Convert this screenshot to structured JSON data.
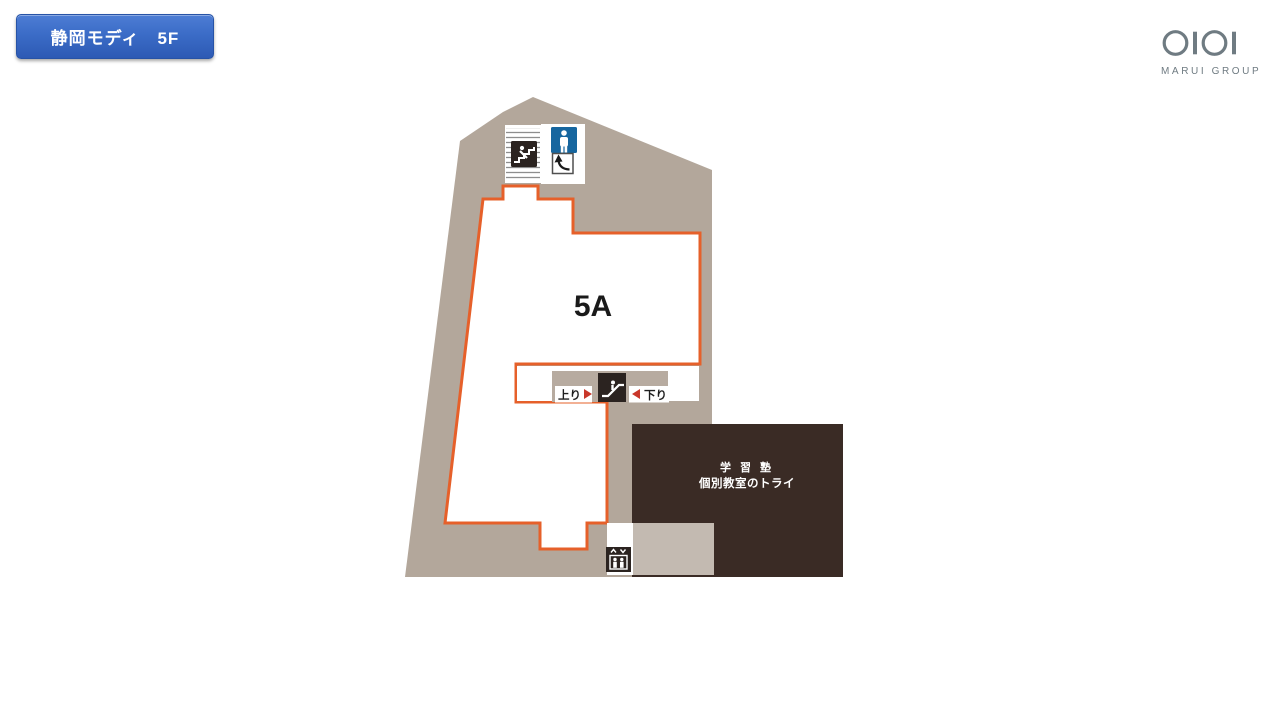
{
  "page": {
    "title_badge": "静岡モディ　5F"
  },
  "logo": {
    "brand": "OIOI",
    "text": "MARUI GROUP"
  },
  "map": {
    "room_label": "5A",
    "escalator": {
      "up": "上り",
      "down": "下り"
    },
    "tenant": {
      "category": "学 習 塾",
      "name": "個別教室のトライ"
    },
    "icons": [
      "stairs-icon",
      "mens-toilet-icon",
      "turn-arrow-icon",
      "escalator-icon",
      "elevator-icon"
    ],
    "colors": {
      "building_beige": "#b3a79b",
      "corridor_beige": "#b7aba0",
      "area_outline_orange": "#e6602a",
      "badge_blue": "#3b6cc7",
      "toilet_blue": "#16669f",
      "tenant_brown": "#3a2b25",
      "tenant_inner_square": "#c3bab1",
      "icon_black": "#2b2320",
      "direction_arrow_red": "#c9372a",
      "logo_gray": "#6f7b82"
    }
  }
}
